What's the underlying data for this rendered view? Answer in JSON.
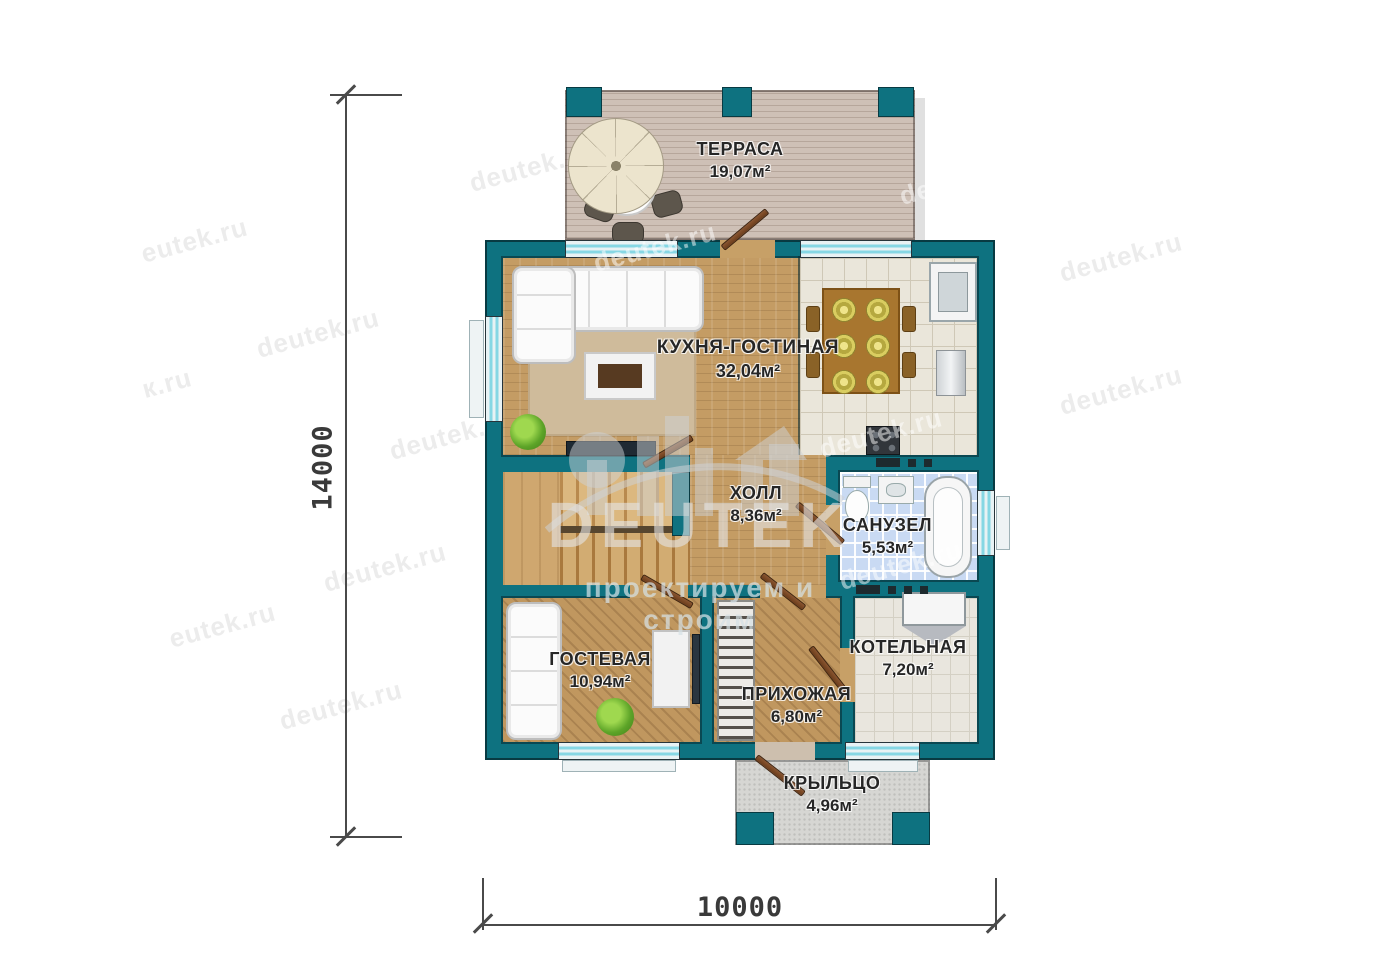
{
  "watermarks": {
    "site": "deutek.ru",
    "site_cut": "eutek.ru",
    "site_cut_small": "к.ru",
    "logo_text": "DEUTEK",
    "logo_tagline": "проектируем и строим"
  },
  "rooms": {
    "terrace": {
      "name": "ТЕРРАСА",
      "area": "19,07м²"
    },
    "kitchen_living": {
      "name": "КУХНЯ-ГОСТИНАЯ",
      "area": "32,04м²"
    },
    "hall": {
      "name": "ХОЛЛ",
      "area": "8,36м²"
    },
    "bathroom": {
      "name": "САНУЗЕЛ",
      "area": "5,53м²"
    },
    "guest": {
      "name": "ГОСТЕВАЯ",
      "area": "10,94м²"
    },
    "entry": {
      "name": "ПРИХОЖАЯ",
      "area": "6,80м²"
    },
    "boiler": {
      "name": "КОТЕЛЬНАЯ",
      "area": "7,20м²"
    },
    "porch": {
      "name": "КРЫЛЬЦО",
      "area": "4,96м²"
    }
  },
  "dimensions": {
    "vertical_mm": "14000",
    "horizontal_mm": "10000"
  },
  "colors": {
    "wall": "#0e7280",
    "window_glass": "#86d7e4",
    "wood_floor": "#c49c64",
    "kitchen_tile": "#eae6da",
    "bathroom_tile": "#c9daf3",
    "terrace_floor": "#cec0b6",
    "porch_floor": "#d6d6d3",
    "door": "#7a4726",
    "dimension_line": "#4a4a4a",
    "label_text": "#262626",
    "watermark": "#ececec"
  }
}
